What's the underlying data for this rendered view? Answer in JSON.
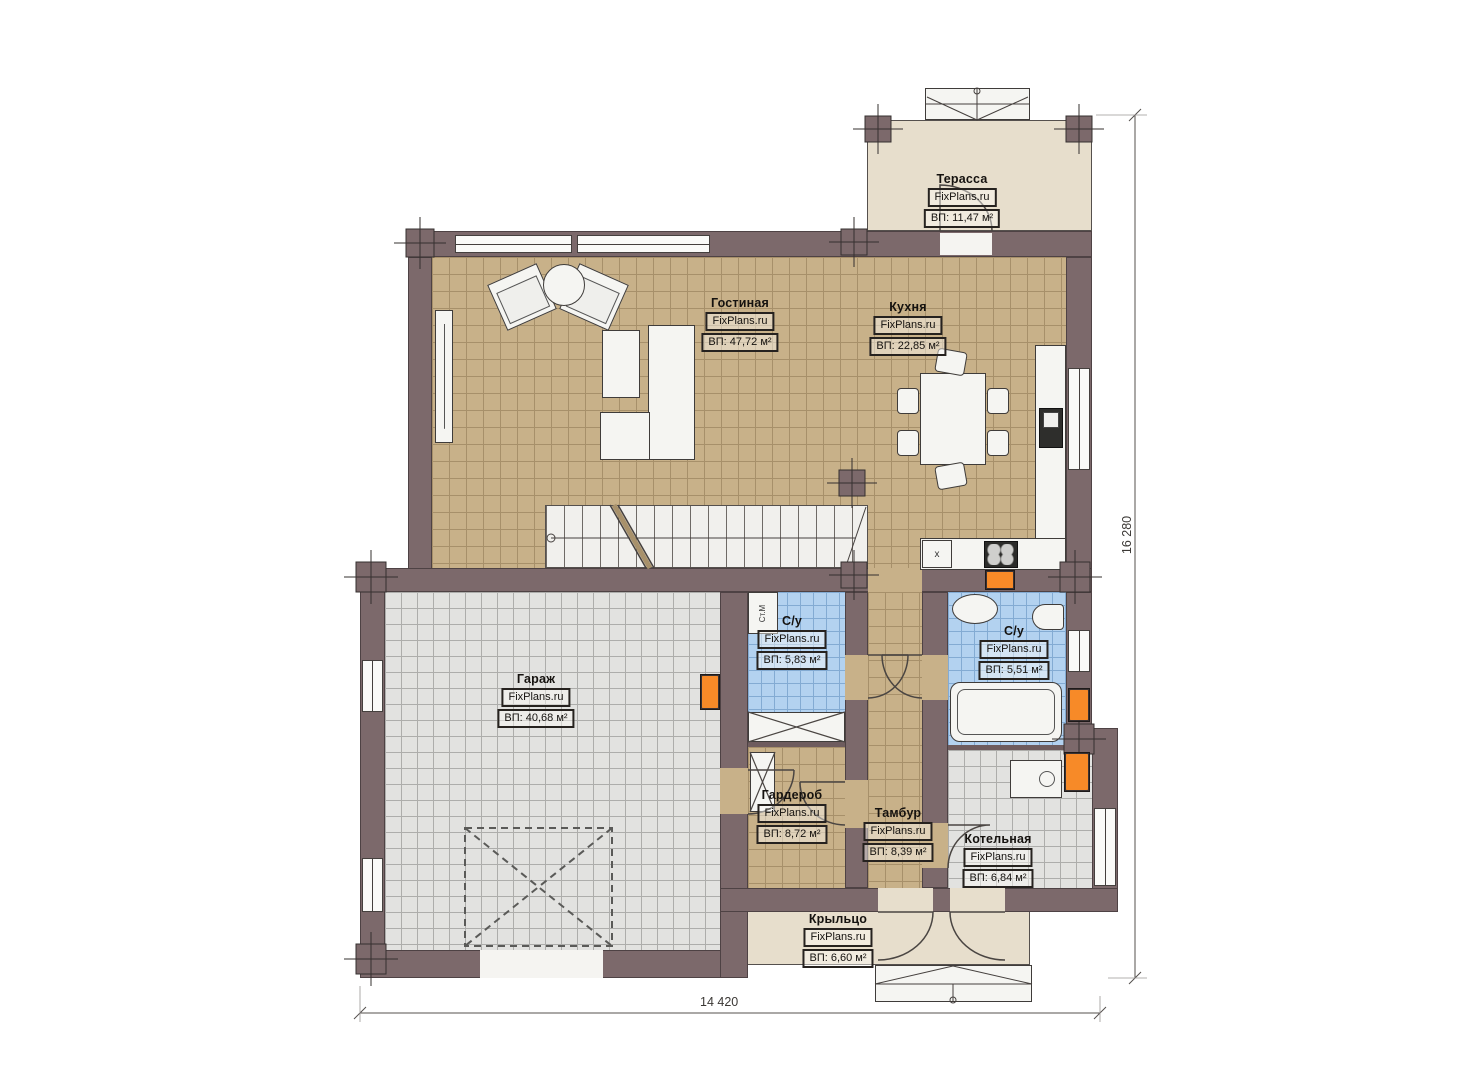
{
  "brand": "FixPlans.ru",
  "rooms": [
    {
      "name": "Терасса",
      "area": "ВП: 11,47 м²"
    },
    {
      "name": "Гостиная",
      "area": "ВП: 47,72 м²"
    },
    {
      "name": "Кухня",
      "area": "ВП: 22,85 м²"
    },
    {
      "name": "Гараж",
      "area": "ВП: 40,68 м²"
    },
    {
      "name": "С/у",
      "area": "ВП: 5,83 м²"
    },
    {
      "name": "С/у",
      "area": "ВП: 5,51 м²"
    },
    {
      "name": "Гардероб",
      "area": "ВП: 8,72 м²"
    },
    {
      "name": "Тамбур",
      "area": "ВП: 8,39 м²"
    },
    {
      "name": "Котельная",
      "area": "ВП: 6,84 м²"
    },
    {
      "name": "Крыльцо",
      "area": "ВП: 6,60 м²"
    }
  ],
  "dimensions": {
    "overall_width": "14 420",
    "overall_height": "16 280"
  },
  "annotations": {
    "washing_machine": "Ст.М",
    "kitchen_sink_mark": "x"
  },
  "colors": {
    "wall": "#7c696b",
    "floor_tile_tan": "#c8b189",
    "floor_tile_blue": "#b3d2f0",
    "floor_tile_gray": "#e2e2e0",
    "outdoor_beige": "#e7decc",
    "radiator_orange": "#f78a28"
  }
}
